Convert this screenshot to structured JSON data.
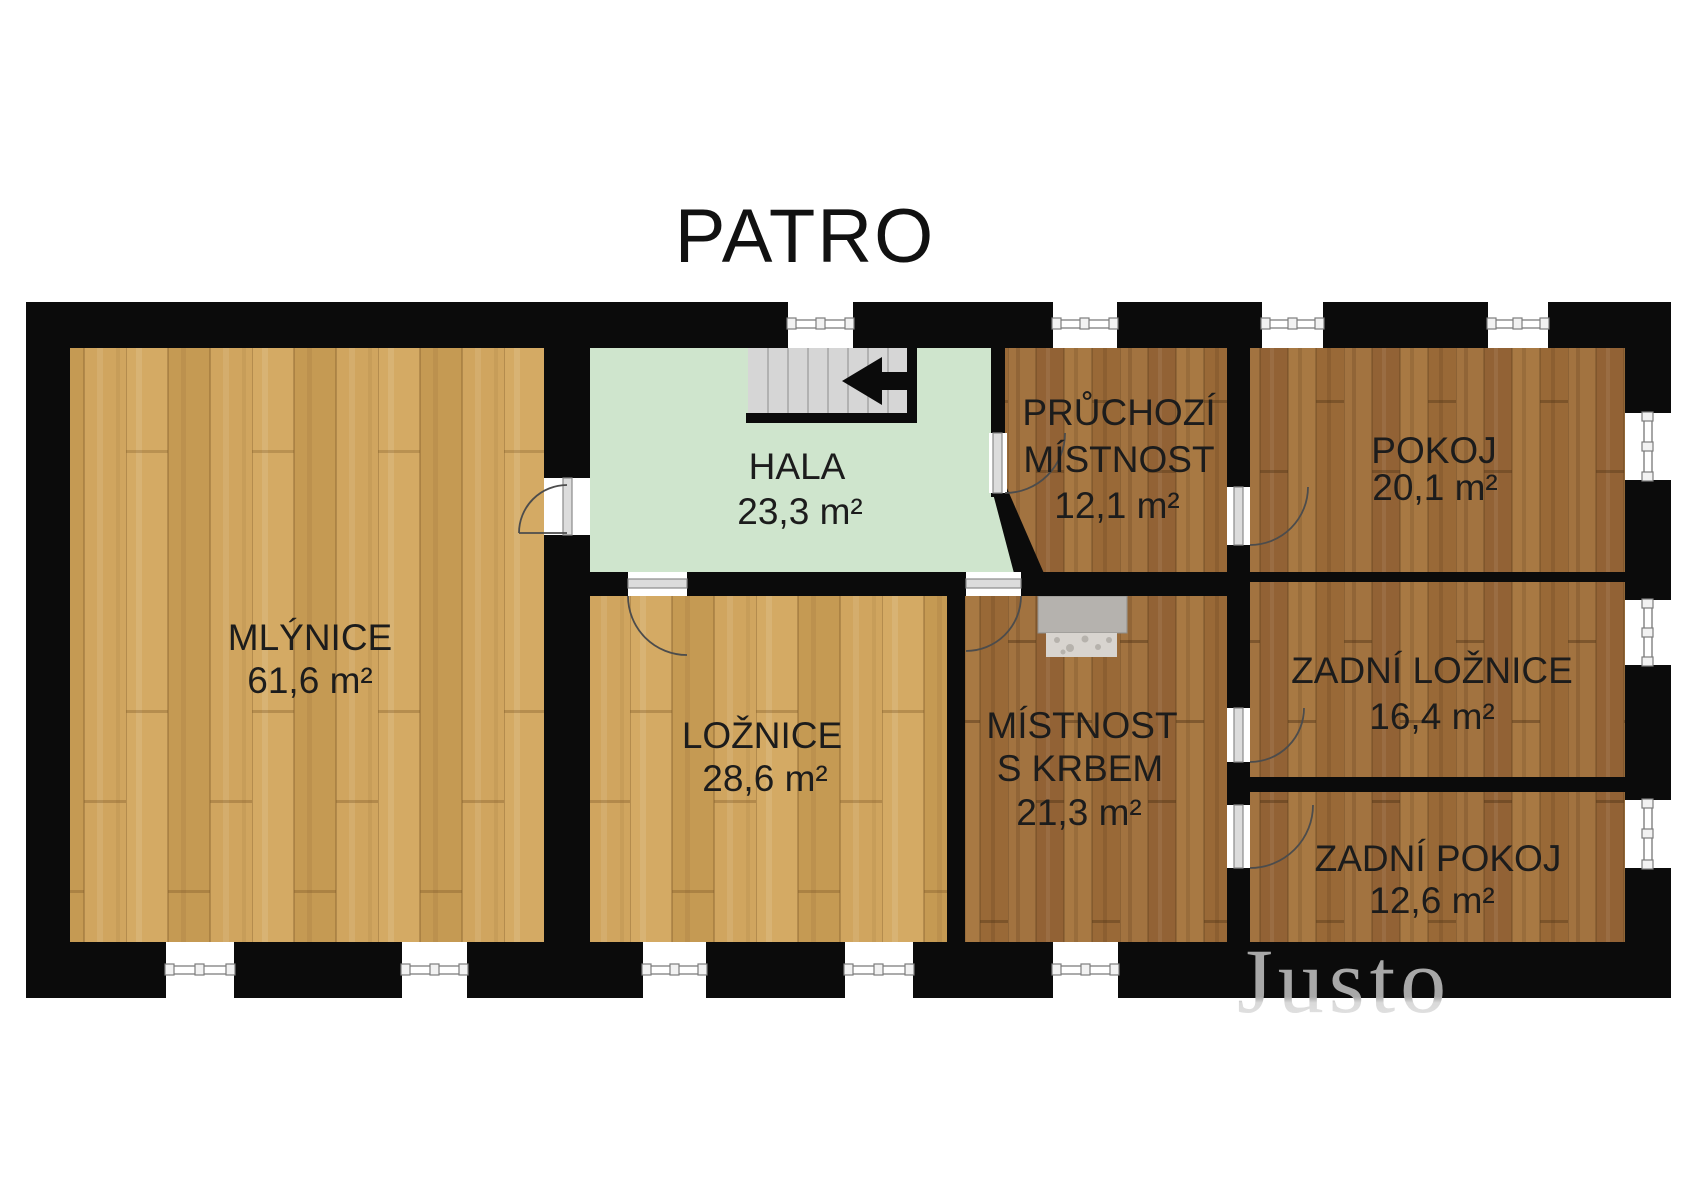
{
  "title": "PATRO",
  "watermark": "Justo",
  "colors": {
    "wall": "#0b0b0b",
    "hala_green": "#cfe5cd",
    "light_wood": "#cda15c",
    "dark_wood": "#9d6e3a",
    "stairs_gray": "#d6d6d6",
    "fireplace_gray": "#b5b2ae",
    "label_text": "#1c1c1c",
    "watermark_gray": "#a6a6a6"
  },
  "rooms": [
    {
      "id": "mlynice",
      "label_lines": [
        "MLÝNICE"
      ],
      "area": "61,6 m²",
      "floor": "light-wood"
    },
    {
      "id": "hala",
      "label_lines": [
        "HALA"
      ],
      "area": "23,3 m²",
      "floor": "green"
    },
    {
      "id": "pruchozi-mistnost",
      "label_lines": [
        "PRŮCHOZÍ",
        "MÍSTNOST"
      ],
      "area": "12,1 m²",
      "floor": "dark-wood"
    },
    {
      "id": "pokoj",
      "label_lines": [
        "POKOJ"
      ],
      "area": "20,1 m²",
      "floor": "dark-wood"
    },
    {
      "id": "loznice",
      "label_lines": [
        "LOŽNICE"
      ],
      "area": "28,6 m²",
      "floor": "light-wood"
    },
    {
      "id": "mistnost-s-krbem",
      "label_lines": [
        "MÍSTNOST",
        "S KRBEM"
      ],
      "area": "21,3 m²",
      "floor": "dark-wood"
    },
    {
      "id": "zadni-loznice",
      "label_lines": [
        "ZADNÍ LOŽNICE"
      ],
      "area": "16,4 m²",
      "floor": "dark-wood"
    },
    {
      "id": "zadni-pokoj",
      "label_lines": [
        "ZADNÍ POKOJ"
      ],
      "area": "12,6 m²",
      "floor": "dark-wood"
    }
  ],
  "features": {
    "stairs_arrow_direction": "left",
    "stairs_treads": 8,
    "fireplace_room": "mistnost-s-krbem",
    "window_count": 12,
    "door_count": 7
  }
}
